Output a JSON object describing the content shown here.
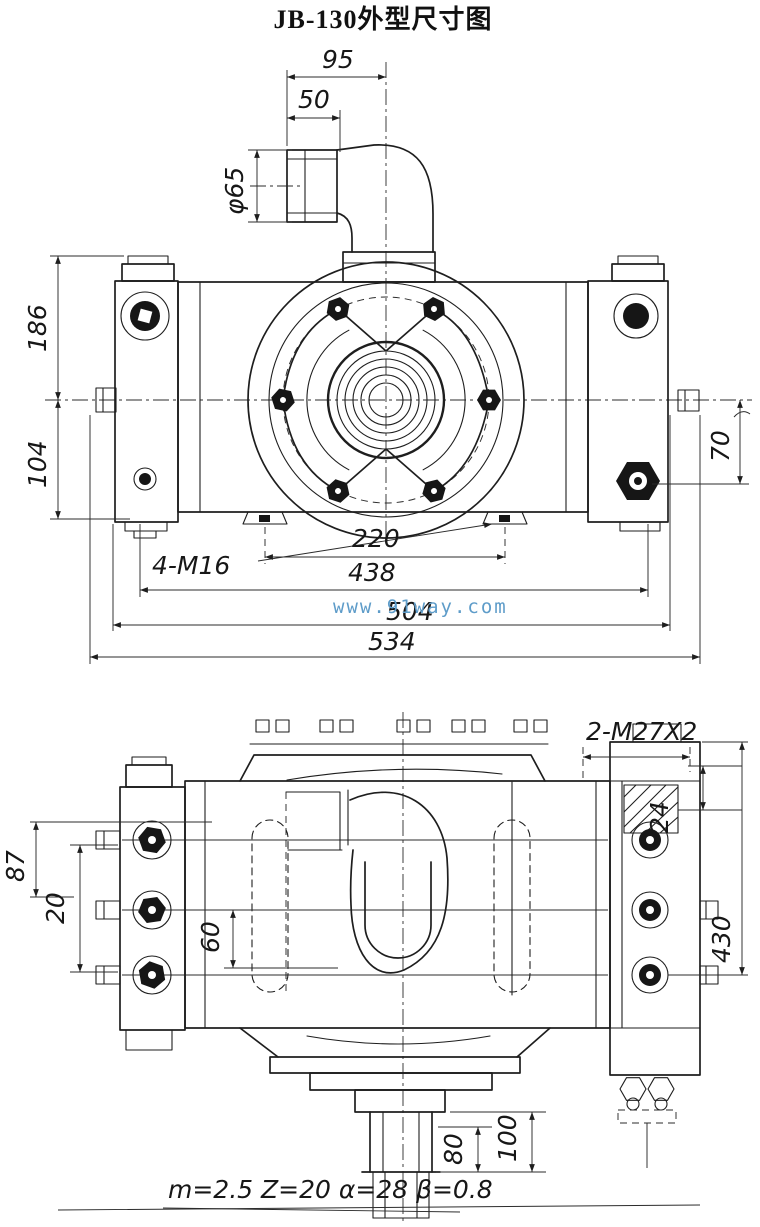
{
  "title": "JB-130外型尺寸图",
  "watermark": "www.91way.com",
  "front_view": {
    "dim_95": "95",
    "dim_50": "50",
    "dim_phi65": "φ65",
    "dim_186": "186",
    "dim_104": "104",
    "dim_70": "70",
    "label_4m16": "4-M16",
    "dim_220": "220",
    "dim_438": "438",
    "dim_504": "504",
    "dim_534": "534"
  },
  "plan_view": {
    "label_2m27x2": "2-M27X2",
    "dim_24": "24",
    "dim_87": "87",
    "dim_20": "20",
    "dim_60": "60",
    "dim_430": "430",
    "dim_80": "80",
    "dim_100": "100",
    "gear_note": "m=2.5 Z=20 α=28 β=0.8"
  },
  "colors": {
    "ink": "#1e1e1e",
    "watermark_blue": "#5e9cc9",
    "paper": "#ffffff"
  }
}
